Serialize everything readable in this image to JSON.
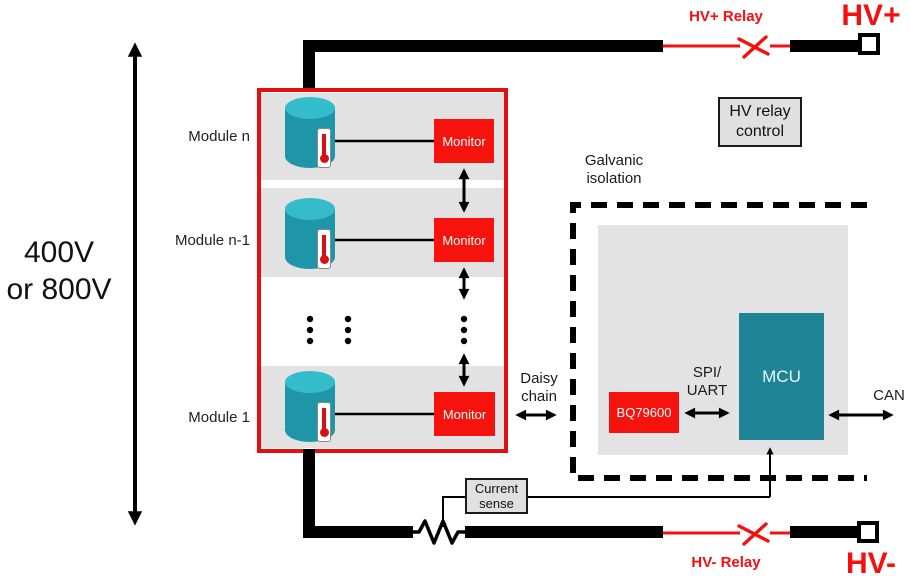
{
  "diagram": {
    "voltage": {
      "line1": "400V",
      "line2": "or 800V"
    },
    "modules": [
      {
        "label": "Module n",
        "monitor": "Monitor"
      },
      {
        "label": "Module n-1",
        "monitor": "Monitor"
      },
      {
        "label": "Module 1",
        "monitor": "Monitor"
      }
    ],
    "daisy_chain": {
      "line1": "Daisy",
      "line2": "chain"
    },
    "isolation": {
      "line1": "Galvanic",
      "line2": "isolation"
    },
    "hv_relay_control": {
      "line1": "HV relay",
      "line2": "control"
    },
    "current_sense": {
      "line1": "Current",
      "line2": "sense"
    },
    "interfaces": {
      "spi_line1": "SPI/",
      "spi_line2": "UART",
      "can": "CAN"
    },
    "chips": {
      "bridge": "BQ79600",
      "mcu": "MCU"
    },
    "hv": {
      "plus_relay": "HV+ Relay",
      "plus": "HV+",
      "minus_relay": "HV- Relay",
      "minus": "HV-"
    },
    "colors": {
      "red": "#F6130D",
      "relay_red": "#F50F0F",
      "pack_border_red": "#E60E0E",
      "cell_teal": "#1F96A8",
      "cell_teal_light": "#35BCCC",
      "mcu_teal": "#1E8395",
      "module_gray": "#E2E2E2",
      "box_gray": "#E0E0E0",
      "bus_black": "#000000"
    }
  }
}
